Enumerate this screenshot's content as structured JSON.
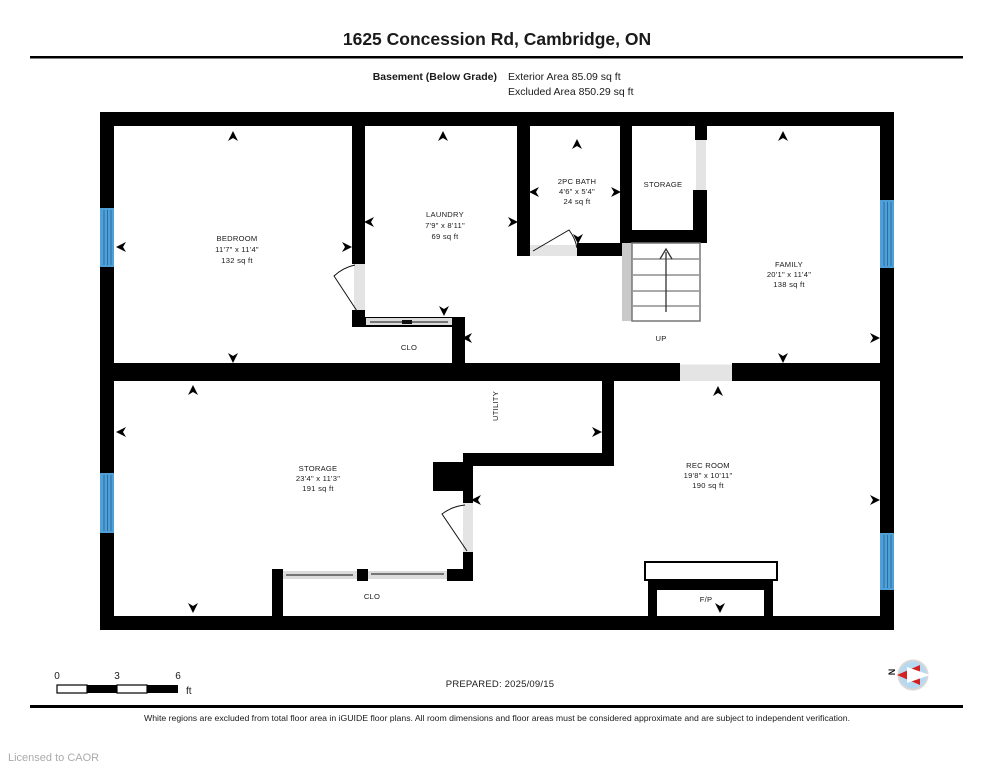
{
  "header": {
    "title": "1625 Concession Rd, Cambridge, ON",
    "floor_label": "Basement (Below Grade)",
    "exterior_area": "Exterior Area 85.09 sq ft",
    "excluded_area": "Excluded Area 850.29 sq ft"
  },
  "rooms": {
    "bedroom": {
      "name": "BEDROOM",
      "dims": "11'7\" x 11'4\"",
      "area": "132 sq ft"
    },
    "laundry": {
      "name": "LAUNDRY",
      "dims": "7'9\" x 8'11\"",
      "area": "69 sq ft"
    },
    "bath": {
      "name": "2PC BATH",
      "dims": "4'6\" x 5'4\"",
      "area": "24 sq ft"
    },
    "storage_top": {
      "name": "STORAGE"
    },
    "family": {
      "name": "FAMILY",
      "dims": "20'1\" x 11'4\"",
      "area": "138 sq ft"
    },
    "storage_bottom": {
      "name": "STORAGE",
      "dims": "23'4\" x 11'3\"",
      "area": "191 sq ft"
    },
    "rec_room": {
      "name": "REC ROOM",
      "dims": "19'8\" x 10'11\"",
      "area": "190 sq ft"
    },
    "closet_top": {
      "name": "CLO"
    },
    "closet_bottom": {
      "name": "CLO"
    },
    "utility": {
      "name": "UTILITY"
    },
    "stairs": {
      "label": "UP"
    },
    "fireplace": {
      "label": "F/P"
    }
  },
  "scale_bar": {
    "tick0": "0",
    "tick1": "3",
    "tick2": "6",
    "unit": "ft"
  },
  "prepared_label": "PREPARED: 2025/09/15",
  "compass": {
    "north_label": "N"
  },
  "footer": {
    "disclaimer": "White regions are excluded from total floor area in iGUIDE floor plans. All room dimensions and floor areas must be considered approximate and are subject to independent verification.",
    "license": "Licensed to CAOR"
  },
  "colors": {
    "wall": "#000000",
    "window": "#4FA0D8",
    "window_stripe": "#2B6E9F",
    "door_opening": "#E4E4E4",
    "stair_landing": "#C9C9C9",
    "compass_fill": "#B5D9F0",
    "compass_needle": "#D42020"
  }
}
